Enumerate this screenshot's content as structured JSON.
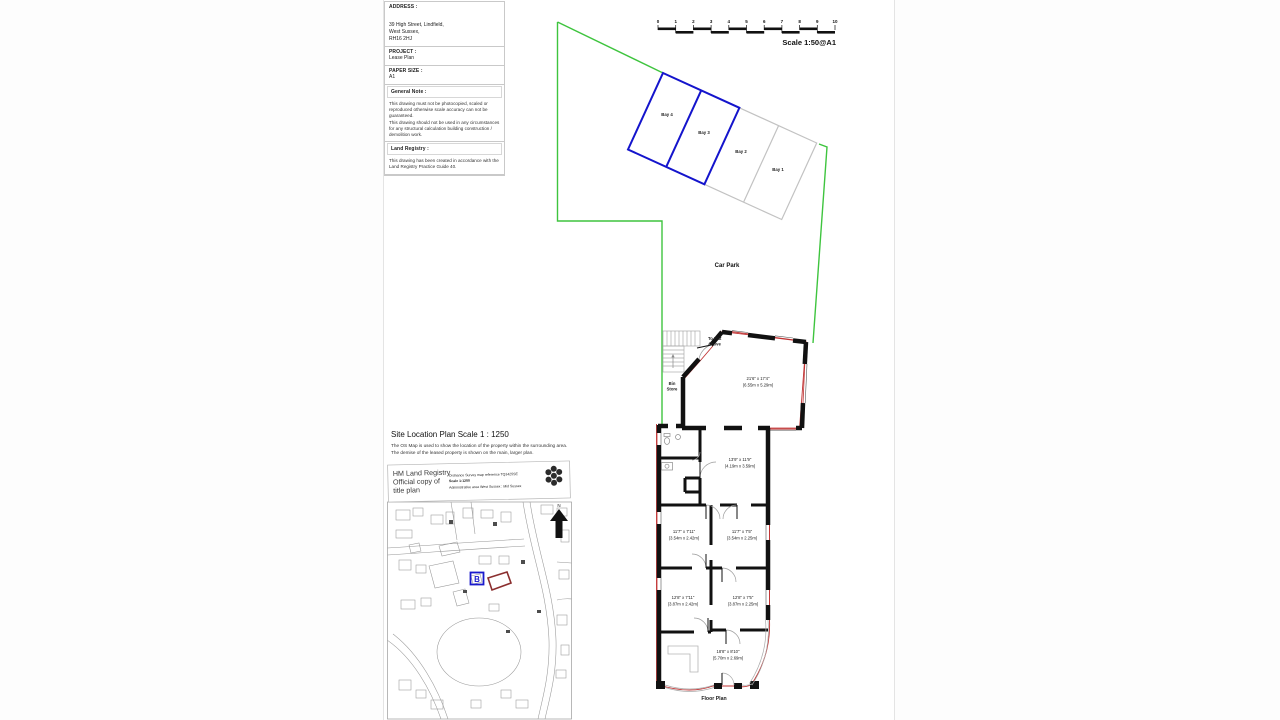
{
  "info_panel": {
    "address_label": "ADDRESS :",
    "address": "39 High Street, Lindfield,\nWest Sussex,\nRH16 2HJ",
    "project_label": "PROJECT :",
    "project": "Lease Plan",
    "paper_size_label": "PAPER SIZE :",
    "paper_size": "A1",
    "general_note_label": "General Note :",
    "general_note_1": "This drawing must not be photocopied, scaled or reproduced otherwise scale accuracy can not be guaranteed.",
    "general_note_2": "This drawing should not be used in any circumstances for any structural calculation building construction / demolition work.",
    "land_registry_label": "Land Registry :",
    "land_registry_note": "This drawing has been created in accordance with the Land Registry Practice Guide 40."
  },
  "scale_bar": {
    "ticks": [
      "0",
      "1",
      "2",
      "3",
      "4",
      "5",
      "6",
      "7",
      "8",
      "9",
      "10"
    ],
    "label": "Scale 1:50@A1"
  },
  "site_plan": {
    "car_park_label": "Car Park",
    "bays": [
      "Bay 4",
      "Bay 3",
      "Bay 2",
      "Bay 1"
    ]
  },
  "floor_plan": {
    "title": "Floor Plan",
    "to_flat_1": "To Flat",
    "to_flat_2": "Above",
    "bin_store_1": "Bin",
    "bin_store_2": "Store",
    "rooms": [
      {
        "imperial": "21'6\" x 17'4\"",
        "metric": "(6.55m x 5.29m)"
      },
      {
        "imperial": "13'9\" x 11'9\"",
        "metric": "(4.19m x 3.59m)"
      },
      {
        "imperial": "11'7\" x 7'11\"",
        "metric": "(3.54m x 2.42m)"
      },
      {
        "imperial": "11'7\" x 7'5\"",
        "metric": "(3.54m x 2.25m)"
      },
      {
        "imperial": "12'8\" x 7'11\"",
        "metric": "(3.87m x 2.42m)"
      },
      {
        "imperial": "12'8\" x 7'5\"",
        "metric": "(3.87m x 2.25m)"
      },
      {
        "imperial": "18'8\" x 8'10\"",
        "metric": "(5.70m x 2.69m)"
      }
    ]
  },
  "location_plan": {
    "title": "Site Location Plan Scale 1 : 1250",
    "description_1": "The OS Map is used to show the location of the property within the surrounding area.",
    "description_2": "The demise of the leased property is shown on the main, larger plan.",
    "hmlr_title_1": "HM Land Registry",
    "hmlr_title_2": "Official copy of",
    "hmlr_title_3": "title plan",
    "os_ref": "Ordnance Survey map reference TQ3425SE",
    "os_scale": "Scale 1:1250",
    "admin_area": "Administrative area West Sussex : Mid Sussex",
    "marker": "B",
    "north_label": "N"
  },
  "colors": {
    "boundary_green": "#3ec43e",
    "bay_blue": "#1414cc",
    "demise_red": "#c03333",
    "wall_black": "#111111",
    "map_gray": "#999999"
  }
}
